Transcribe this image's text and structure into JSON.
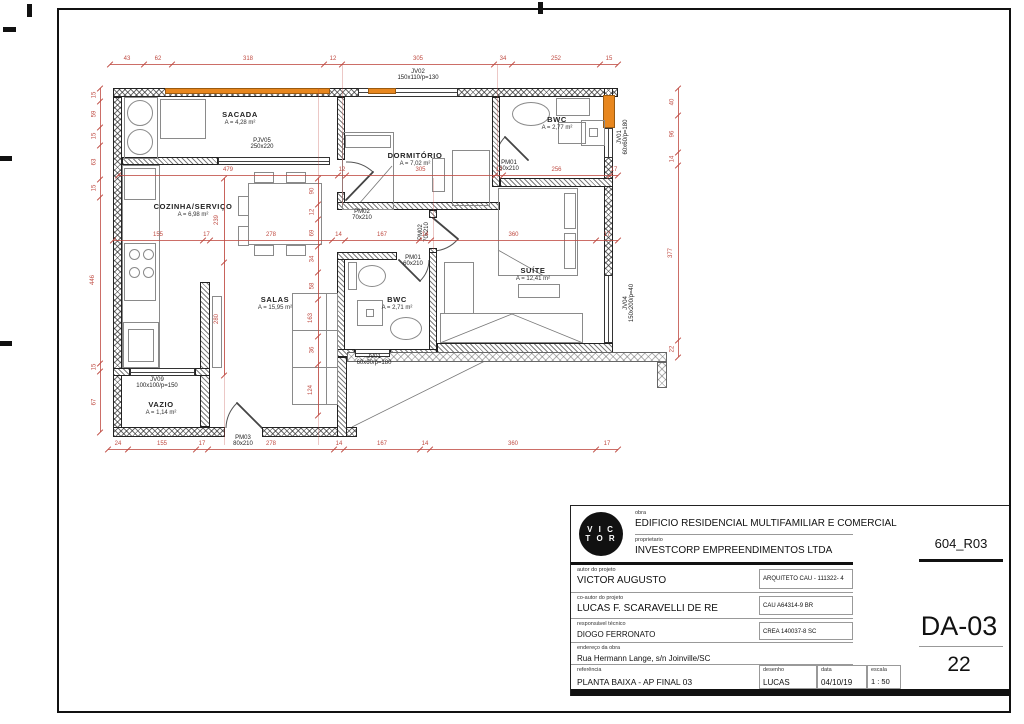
{
  "sheet": {
    "revision": "604_R03",
    "code": "DA-03",
    "number": "22"
  },
  "titleblock": {
    "logo_line1": "V I C",
    "logo_line2": "T O R",
    "obra_label": "obra",
    "obra": "EDIFICIO RESIDENCIAL MULTIFAMILIAR E COMERCIAL",
    "proprietario_label": "proprietario",
    "proprietario": "INVESTCORP EMPREENDIMENTOS LTDA",
    "autor_label": "autor do projeto",
    "autor": "VICTOR AUGUSTO",
    "autor_reg": "ARQUITETO CAU - 111322- 4",
    "coautor_label": "co-autor do projeto",
    "coautor": "LUCAS F. SCARAVELLI DE RE",
    "coautor_reg": "CAU A64314-9 BR",
    "resp_label": "responsável técnico",
    "resp": "DIOGO FERRONATO",
    "resp_reg": "CREA 140037-8 SC",
    "endereco_label": "endereço da obra",
    "endereco": "Rua Hermann Lange, s/n Joinville/SC",
    "referencia_label": "referência",
    "referencia": "PLANTA BAIXA - AP FINAL 03",
    "desenho_label": "desenho",
    "desenho": "LUCAS",
    "data_label": "data",
    "data": "04/10/19",
    "escala_label": "escala",
    "escala": "1 : 50"
  },
  "plan": {
    "rooms": [
      {
        "name": "SACADA",
        "area": "A = 4,28 m²"
      },
      {
        "name": "DORMITÓRIO",
        "area": "A = 7,02 m²"
      },
      {
        "name": "BWC",
        "area": "A = 2,77 m²"
      },
      {
        "name": "COZINHA/SERVIÇO",
        "area": "A = 6,98 m²"
      },
      {
        "name": "SALAS",
        "area": "A = 15,95 m²"
      },
      {
        "name": "BWC",
        "area": "A = 2,71 m²"
      },
      {
        "name": "SUÍTE",
        "area": "A = 12,41 m²"
      },
      {
        "name": "VAZIO",
        "area": "A = 1,14 m²"
      }
    ],
    "openings": [
      {
        "tag": "JV02",
        "size": "150x110/p=130"
      },
      {
        "tag": "PJV05",
        "size": "250x220"
      },
      {
        "tag": "PM02",
        "size": "70x210"
      },
      {
        "tag": "PM01",
        "size": "60x210"
      },
      {
        "tag": "PM01",
        "size": "60x210"
      },
      {
        "tag": "PM02",
        "size": "70x210"
      },
      {
        "tag": "PM03",
        "size": "80x210"
      },
      {
        "tag": "JV09",
        "size": "100x100/p=150"
      },
      {
        "tag": "JV01",
        "size": "60x60/p=180"
      },
      {
        "tag": "JV01",
        "size": "60x60/p=180"
      },
      {
        "tag": "JV04",
        "size": "150x200/p=40"
      }
    ],
    "dimensions": {
      "top": [
        "43",
        "62",
        "318",
        "12",
        "305",
        "34",
        "252",
        "15"
      ],
      "upper": [
        "479",
        "12",
        "305",
        "12",
        "256",
        "17"
      ],
      "mid": [
        "155",
        "17",
        "278",
        "14",
        "167",
        "14",
        "360",
        "17"
      ],
      "bottom": [
        "24",
        "155",
        "17",
        "278",
        "14",
        "167",
        "14",
        "360",
        "17"
      ],
      "left": [
        "15",
        "59",
        "15",
        "63",
        "15",
        "446",
        "15",
        "67"
      ],
      "right": [
        "40",
        "96",
        "14",
        "377",
        "22"
      ],
      "kitchen": [
        "239",
        "280"
      ],
      "hall": [
        "90",
        "12",
        "69",
        "34",
        "58",
        "163",
        "36",
        "124"
      ]
    }
  }
}
